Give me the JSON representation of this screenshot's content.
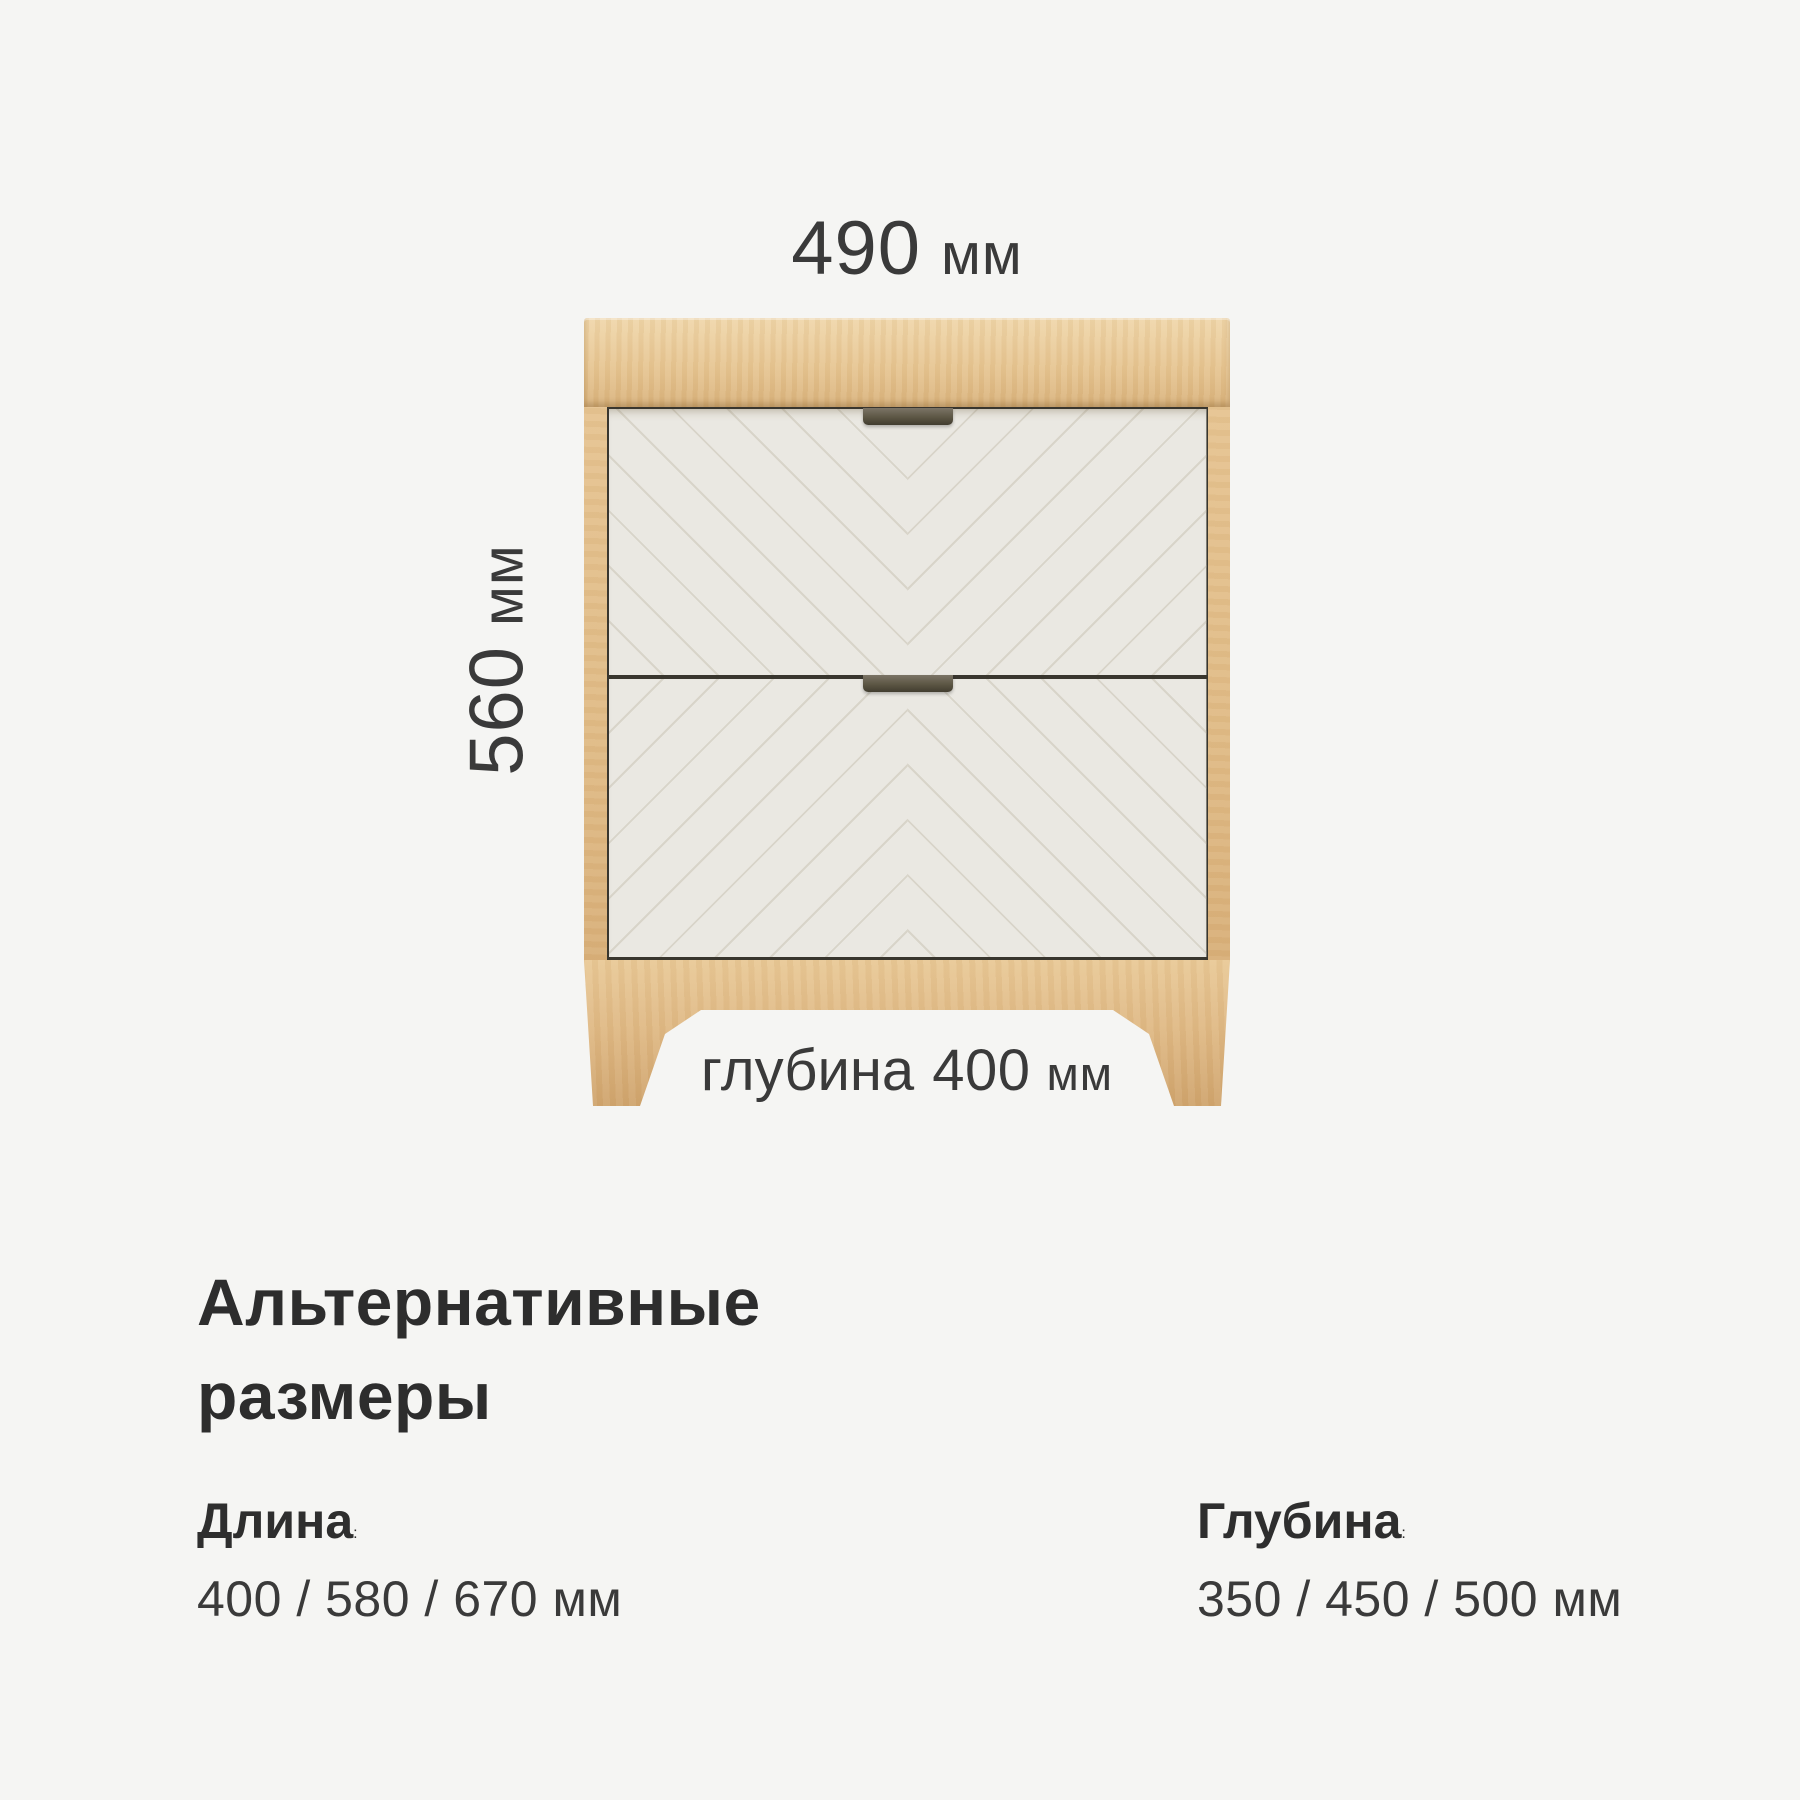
{
  "card": {
    "background": "#f5f5f3"
  },
  "dimensions": {
    "width": {
      "value": "490",
      "unit": "мм"
    },
    "height": {
      "value": "560",
      "unit": "мм"
    },
    "depth": {
      "prefix": "глубина",
      "value": "400",
      "unit": "мм"
    }
  },
  "alt_sizes": {
    "heading": "Альтернативные размеры",
    "colon": ":",
    "length": {
      "label": "Длина",
      "values": "400 / 580 / 670 мм"
    },
    "depth": {
      "label": "Глубина",
      "values": "350 / 450 / 500 мм"
    }
  },
  "illustration": {
    "subject": "two-drawer nightstand",
    "colors": {
      "wood": "#e3bf8c",
      "wood_light": "#f0d7ab",
      "wood_dark": "#d0a56e",
      "drawer_front": "#eae8e2",
      "chevron_line": "#d8d4c9",
      "handle": "#5c5644",
      "seam": "#39362e",
      "text": "#3a3a3a",
      "heading_text": "#2d2d2d"
    }
  }
}
